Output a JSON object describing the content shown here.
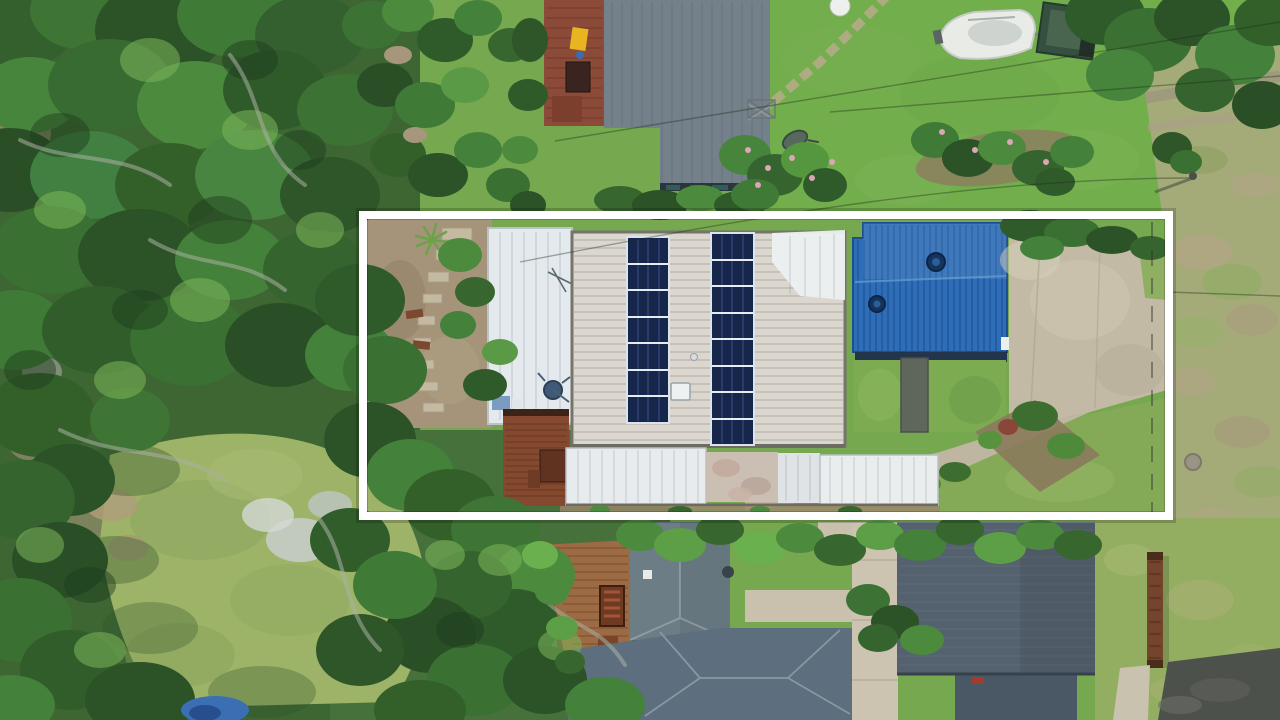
{
  "scene": {
    "type": "aerial-drone-photograph",
    "description": "Top-down aerial photo of a coastal residential block. A white rectangular overlay marks the property boundary around a house with two columns of rooftop solar panels, a pale carport roof, a bright blue metal roof, timber decks, lawns and a curving concrete driveway. Dense gum-tree canopy fills the left side, neighbouring grey-roofed houses sit above and below, a boat on a trailer is parked top right, and a dry grass road verge runs down the right edge.",
    "overlay": {
      "purpose": "property-boundary-outline",
      "shape": "rectangle",
      "color": "#ffffff"
    }
  },
  "solar_array": {
    "left_column_panels": 7,
    "right_column_panels": 8
  },
  "palette": {
    "boundary_line": "#ffffff",
    "forest": "#3d6632",
    "lawn_base": "#76a84f",
    "top_lawn": "#72ae4c",
    "clearing": "#9db368",
    "dry_verge": "#a4ab79",
    "main_roof": "#dbd7cf",
    "carport_roof": "#e3e9ec",
    "pergola_roof": "#edf0f1",
    "blue_roof": "#2e6db8",
    "solar_panel": "#17264b",
    "neighbor_roof": "#74808a",
    "lower_roof_wing": "#66767f",
    "lower_roof_main": "#5d6e7e",
    "lower_roof_b": "#54616e",
    "white_lower_roof": "#e7ebed",
    "weathered_roof": "#cbbfb3",
    "driveway": "#c3baa5",
    "concrete_path": "#ccc4b1",
    "deck_wood": "#84492f",
    "timber_deck": "#9c6b44",
    "asphalt": "#4d514b",
    "dirt": "#a5947a",
    "boat_hull": "#e9ebe7",
    "trailer_box_green": "#35503e",
    "blue_tarp": "#3a6fb4",
    "retaining_wall": "#74452c"
  },
  "objects": [
    "tree-canopy",
    "lawns",
    "solar-panel-roof",
    "carport-roof",
    "blue-metal-roof",
    "pergola-roof",
    "timber-decks",
    "concrete-driveway",
    "boat-on-trailer",
    "satellite-dish",
    "tv-antenna",
    "clothesline",
    "wheelbarrow",
    "stepping-stones",
    "garden-beds",
    "hedges",
    "neighbor-houses",
    "dirt-road-verge",
    "asphalt-driveway",
    "retaining-wall",
    "blue-tarp",
    "shade-structure",
    "power-lines",
    "power-pole",
    "skylight",
    "roof-vents",
    "wire-fence",
    "manhole-cover"
  ]
}
